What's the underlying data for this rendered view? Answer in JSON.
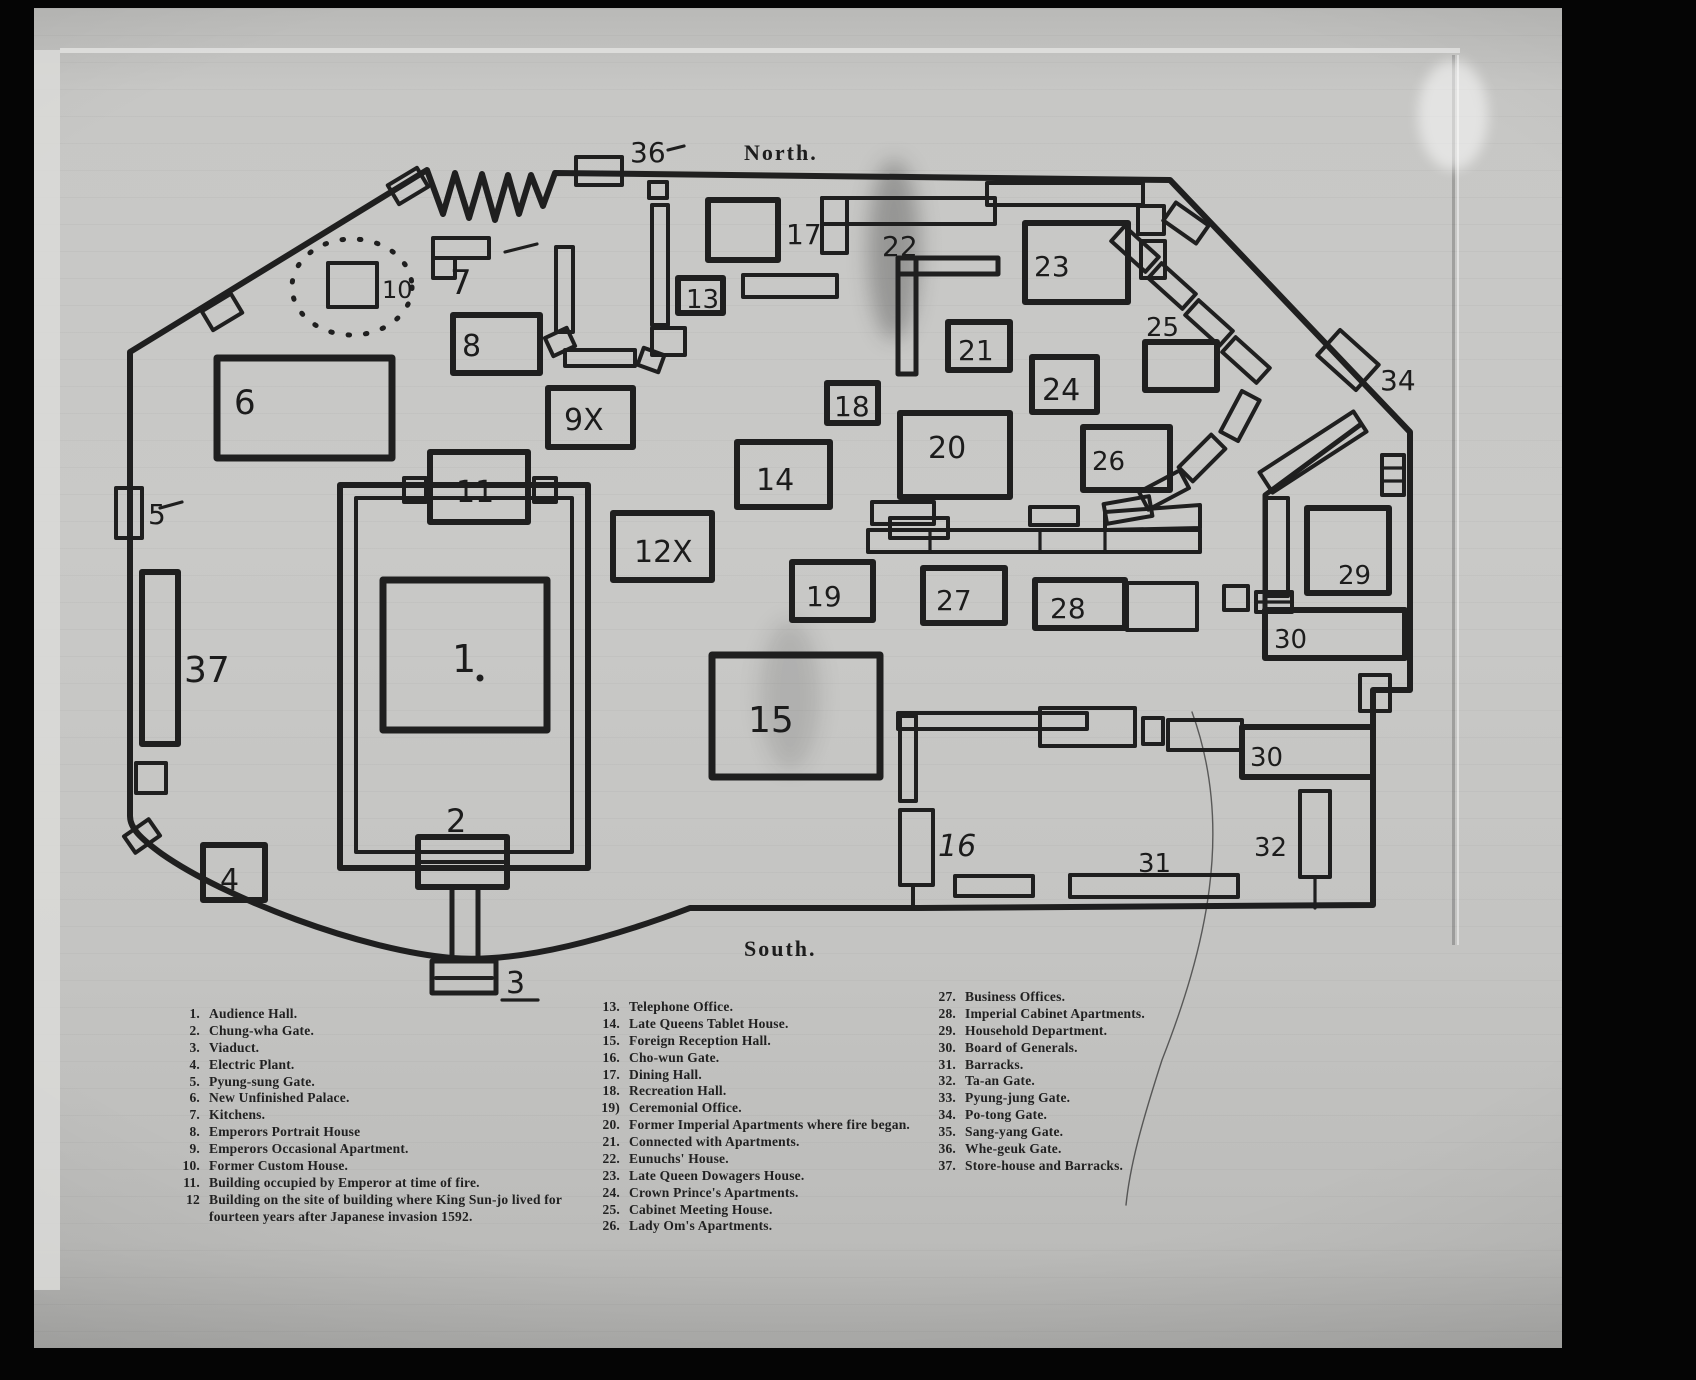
{
  "colors": {
    "ink": "#1f1f1f",
    "paper": "#c6c6c4",
    "background": "#050505"
  },
  "map": {
    "compass": {
      "north": "North.",
      "south": "South."
    },
    "marks": {
      "m1": "1",
      "m2": "2",
      "m3": "3",
      "m4": "4",
      "m5": "5",
      "m6": "6",
      "m7": "7",
      "m8": "8",
      "m9x": "9X",
      "m10": "10",
      "m11": "11",
      "m12x": "12X",
      "m13": "13",
      "m14": "14",
      "m15": "15",
      "m16": "16",
      "m17": "17",
      "m18": "18",
      "m19": "19",
      "m20": "20",
      "m21": "21",
      "m22": "22",
      "m23": "23",
      "m24": "24",
      "m25": "25",
      "m26": "26",
      "m27": "27",
      "m28": "28",
      "m29": "29",
      "m30a": "30",
      "m30b": "30",
      "m31": "31",
      "m32": "32",
      "m34": "34",
      "m36": "36",
      "m37": "37"
    }
  },
  "legend": {
    "col1": [
      {
        "num": "1.",
        "text": "Audience Hall."
      },
      {
        "num": "2.",
        "text": "Chung-wha Gate."
      },
      {
        "num": "3.",
        "text": "Viaduct."
      },
      {
        "num": "4.",
        "text": "Electric Plant."
      },
      {
        "num": "5.",
        "text": "Pyung-sung Gate."
      },
      {
        "num": "6.",
        "text": "New Unfinished Palace."
      },
      {
        "num": "7.",
        "text": "Kitchens."
      },
      {
        "num": "8.",
        "text": "Emperors Portrait House"
      },
      {
        "num": "9.",
        "text": "Emperors Occasional Apartment."
      },
      {
        "num": "10.",
        "text": "Former Custom House."
      },
      {
        "num": "11.",
        "text": "Building occupied by Emperor at time of fire."
      },
      {
        "num": "12",
        "text": "Building on the site of building where King Sun-jo lived for fourteen years after Japanese invasion 1592."
      }
    ],
    "col2": [
      {
        "num": "13.",
        "text": "Telephone Office."
      },
      {
        "num": "14.",
        "text": "Late Queens Tablet House."
      },
      {
        "num": "15.",
        "text": "Foreign Reception Hall."
      },
      {
        "num": "16.",
        "text": "Cho-wun Gate."
      },
      {
        "num": "17.",
        "text": "Dining Hall."
      },
      {
        "num": "18.",
        "text": "Recreation Hall."
      },
      {
        "num": "19)",
        "text": "Ceremonial Office."
      },
      {
        "num": "20.",
        "text": "Former Imperial Apartments where fire began."
      },
      {
        "num": "21.",
        "text": "Connected with Apartments."
      },
      {
        "num": "22.",
        "text": "Eunuchs' House."
      },
      {
        "num": "23.",
        "text": "Late Queen Dowagers House."
      },
      {
        "num": "24.",
        "text": "Crown Prince's Apartments."
      },
      {
        "num": "25.",
        "text": "Cabinet Meeting House."
      },
      {
        "num": "26.",
        "text": "Lady Om's Apartments."
      }
    ],
    "col3": [
      {
        "num": "27.",
        "text": "Business Offices."
      },
      {
        "num": "28.",
        "text": "Imperial Cabinet Apartments."
      },
      {
        "num": "29.",
        "text": "Household Department."
      },
      {
        "num": "30.",
        "text": "Board of Generals."
      },
      {
        "num": "31.",
        "text": "Barracks."
      },
      {
        "num": "32.",
        "text": "Ta-an Gate."
      },
      {
        "num": "33.",
        "text": "Pyung-jung Gate."
      },
      {
        "num": "34.",
        "text": "Po-tong Gate."
      },
      {
        "num": "35.",
        "text": "Sang-yang Gate."
      },
      {
        "num": "36.",
        "text": "Whe-geuk Gate."
      },
      {
        "num": "37.",
        "text": "Store-house and Barracks."
      }
    ]
  }
}
